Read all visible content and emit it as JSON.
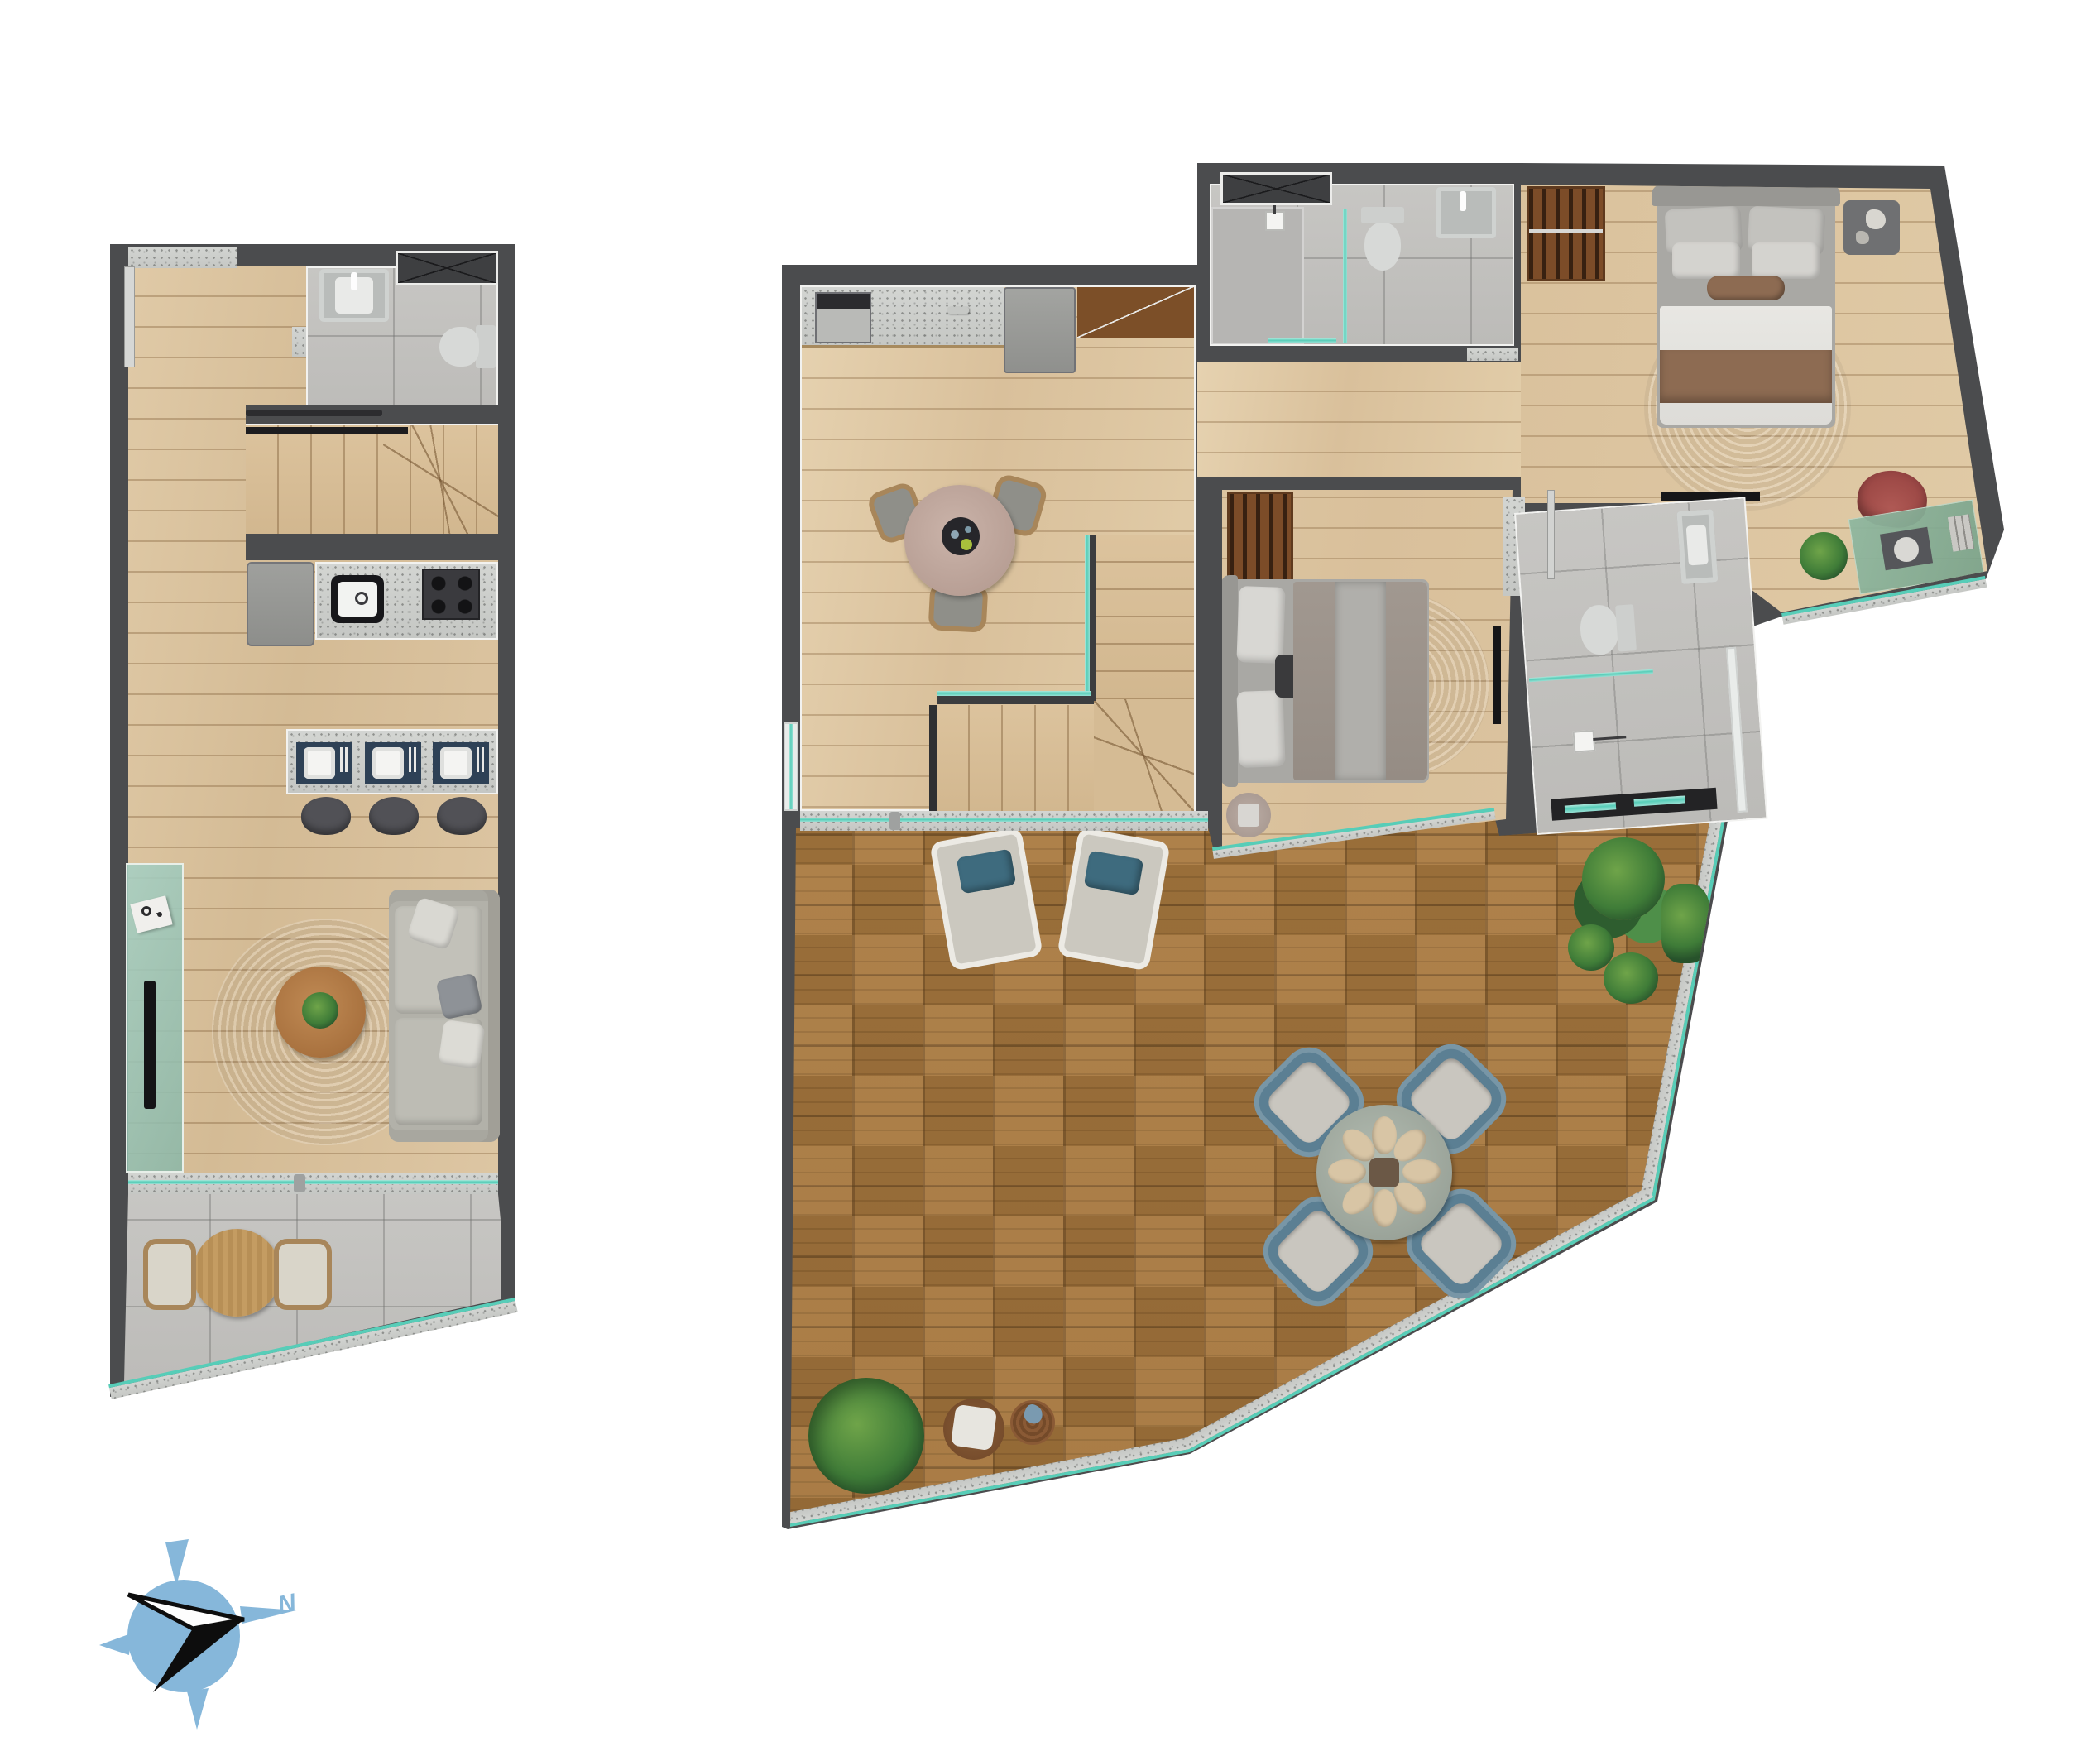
{
  "compass": {
    "label": "N",
    "color": "#86b7da",
    "needle_colors": [
      "#fdfdfd",
      "#0d0d0d"
    ]
  },
  "palette": {
    "background": "#ffffff",
    "wall": "#4b4c4e",
    "wall_trim": "#f2f2f0",
    "interior_wood": "#dcc6a4",
    "stair_wood": "#d6bd97",
    "deck_wood": "#ab7b40",
    "bathroom_tile": "#c2c1bf",
    "terrazzo": "#cdcfcc",
    "glass_teal": "#57cdb8",
    "glass_panel": "#9cc4b4",
    "rug": "#d2c9bc",
    "sofa_gray": "#b2b1a9",
    "navy_accent": "#2e4156",
    "stool_gray": "#515156",
    "bed_blanket_brown": "#8d6b52",
    "bed_duvet": "#e6e5e1",
    "outdoor_chair_teal": "#5b7f93",
    "accent_chair_red": "#9e4a47",
    "plant_green": "#3f7c38",
    "table_wood": "#b5804c"
  },
  "units": [
    {
      "id": "duplex-lower-floor",
      "rooms": [
        "entry",
        "bathroom",
        "stairs",
        "kitchen",
        "breakfast-bar",
        "living-room",
        "balcony"
      ],
      "furniture": [
        "entry-door",
        "wardrobe",
        "vanity-sink",
        "toilet",
        "staircase",
        "refrigerator",
        "kitchen-sink",
        "gas-stove",
        "bar-placemats",
        "bar-stools",
        "glass-sideboard",
        "tv",
        "round-rug",
        "coffee-table",
        "sofa",
        "sliding-door",
        "outdoor-table",
        "outdoor-chairs",
        "glass-railing"
      ]
    },
    {
      "id": "duplex-upper-floor",
      "rooms": [
        "living-dining",
        "kitchenette",
        "bathroom-1",
        "bedroom-1",
        "desk-nook",
        "bedroom-2",
        "bathroom-2",
        "stairs",
        "roof-deck"
      ],
      "furniture": [
        "counter-appliance",
        "refrigerator",
        "pantry",
        "dining-table",
        "wicker-chairs",
        "staircase",
        "glass-railing",
        "wardrobe-x",
        "shower",
        "toilet",
        "wall-basin",
        "clothes-rack",
        "double-bed",
        "round-rug",
        "nightstand",
        "tv",
        "desk",
        "desk-chair",
        "potted-plant",
        "wardrobe-slatted",
        "side-table",
        "loungers",
        "outdoor-dining-table",
        "outdoor-armchairs",
        "planters",
        "pouf",
        "basket-table"
      ]
    }
  ]
}
